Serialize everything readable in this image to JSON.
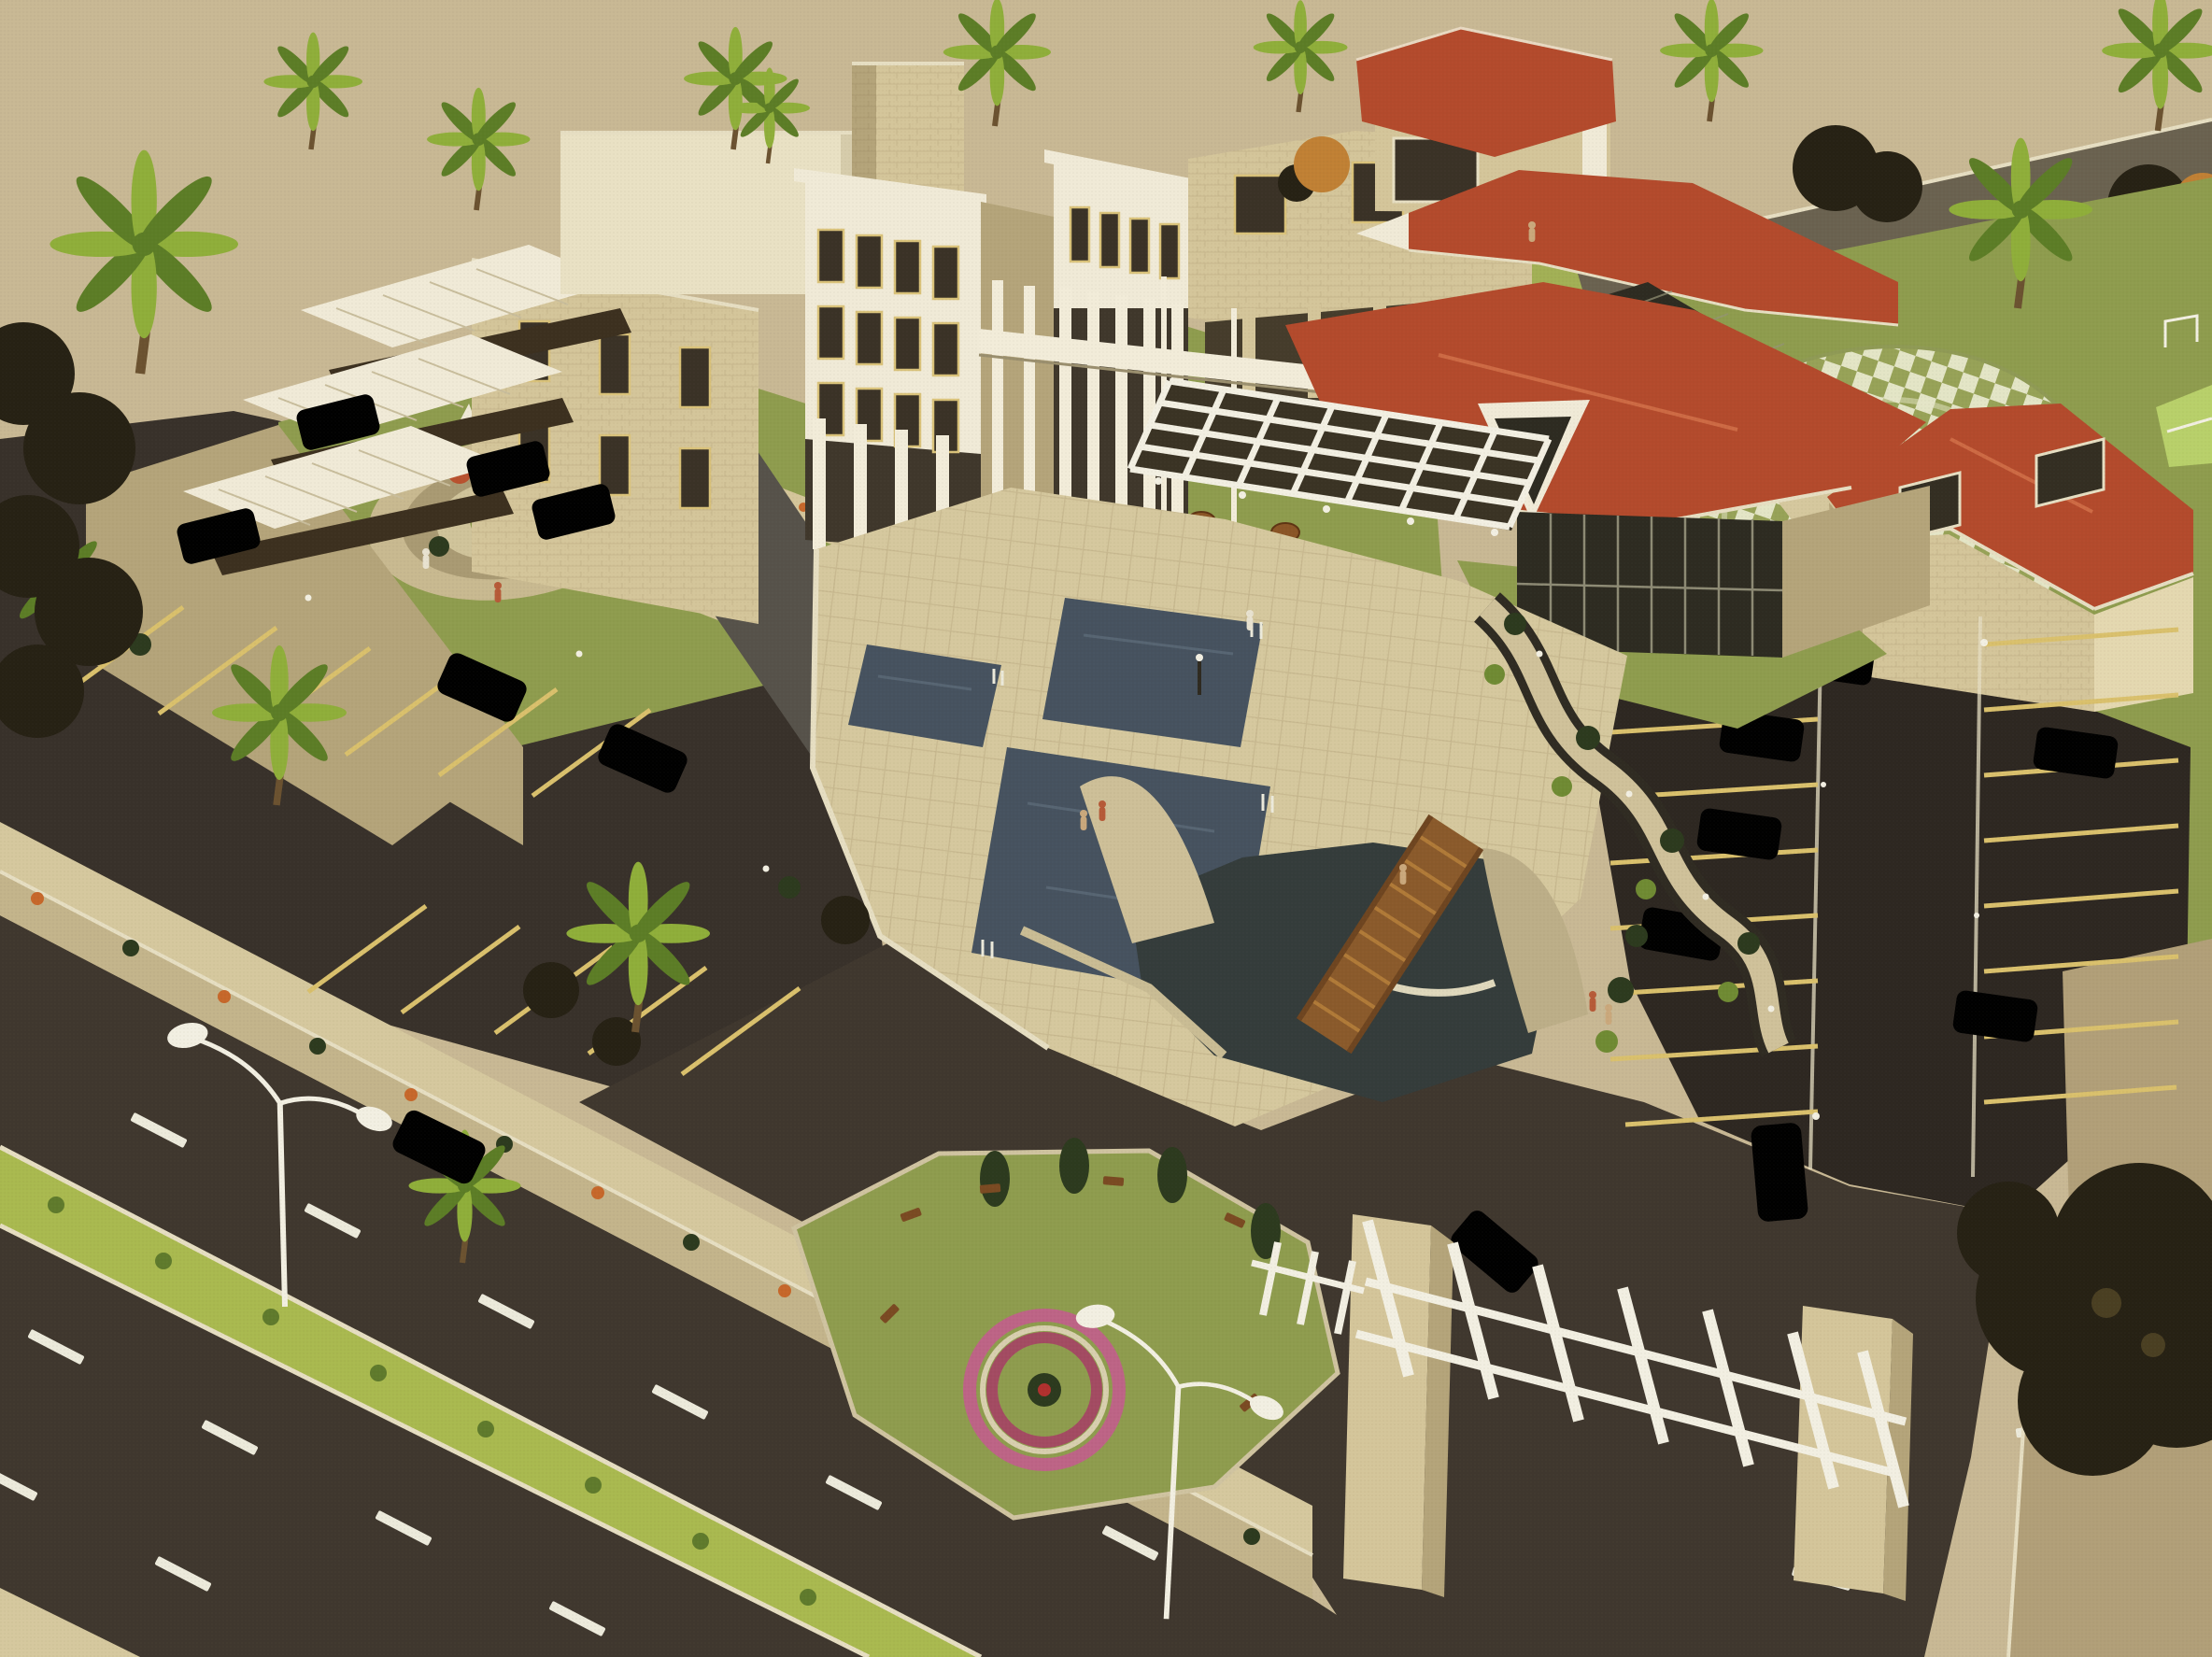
{
  "scene": {
    "type": "aerial architectural rendering",
    "description": "Bird's-eye 3D visualization of a resort hotel complex: stone hotel blocks with white colonnades and a terraced apartment wing, red hip-roof pavilions with glass atriums, three dark swimming pools on a paved deck, rooftop garden with circular mosaic, outdoor umbrella seating, circular checkered plaza, tennis court, two parking lots with yellow-lined stalls, serpentine planted walkway, water feature with arched wooden bridge, gated entrance with white pergola trellis, and a dual-carriageway road with a green median along the lower edge.",
    "areas": [
      {
        "name": "terraced-wing",
        "label": "Stepped apartment wing with white balcony canopies"
      },
      {
        "name": "main-hotel",
        "label": "Main hotel blocks with white columns and sky bridge"
      },
      {
        "name": "roof-garden",
        "label": "Roof garden terrace with circular mosaic and sculpture"
      },
      {
        "name": "red-roof-cluster",
        "label": "Red hip-roof halls with dark glass atriums"
      },
      {
        "name": "pool-pavilion",
        "label": "Red-roof pool pavilion with glass front and white pergola"
      },
      {
        "name": "pool-deck",
        "label": "Paved deck with three dark pools"
      },
      {
        "name": "umbrella-terrace",
        "label": "Outdoor seating with umbrella tables"
      },
      {
        "name": "checkered-plaza",
        "label": "Circular checkered paving plaza"
      },
      {
        "name": "right-lodge",
        "label": "Red-roof stone lodge beside plaza"
      },
      {
        "name": "left-parking",
        "label": "West parking lot with palms"
      },
      {
        "name": "right-parking",
        "label": "East parking lot with center aisle"
      },
      {
        "name": "serpentine-path",
        "label": "Winding planted walkway"
      },
      {
        "name": "water-feature",
        "label": "Pond with sail walls and arched wooden bridge"
      },
      {
        "name": "garden-island",
        "label": "Lawn island with benches and circular flower bed"
      },
      {
        "name": "entrance-gate",
        "label": "Stone pylon gate with white trellis"
      },
      {
        "name": "public-road",
        "label": "Dual carriageway with green median and street lamps"
      },
      {
        "name": "tennis-court",
        "label": "Tennis court at east lawn edge"
      }
    ],
    "counts": {
      "pools": 3,
      "umbrella_tables": 18,
      "palm_trees": 13,
      "street_lamps": 2,
      "gate_pylons": 2,
      "cars_white": 8,
      "cars_dark": 6,
      "cars_silver": 1
    }
  },
  "palette": {
    "sky": "#c8b894",
    "stone": "#d4c59a",
    "stone_dark": "#b4a47a",
    "stone_light": "#e4d8b0",
    "white_building": "#f0ead7",
    "window_dark": "#3a3226",
    "red_roof": "#b34a2c",
    "roof_ridge": "#cd6a44",
    "glass_dark": "#2d2b21",
    "grass": "#8e9c4e",
    "grass_light": "#a2b055",
    "asphalt": "#38312a",
    "asphalt_dark": "#2d2721",
    "roadway": "#3f372e",
    "median_green": "#a9b94f",
    "pavement": "#d5c89e",
    "pool_water": "#46525f",
    "feature_water": "#343c3b",
    "wood_bridge": "#8a5a2b",
    "wood_slat": "#b07a38",
    "gravel": "#b19f78",
    "stall_line": "#d9c06c",
    "lane_dash": "#eceadb",
    "curb": "#e6dec2",
    "checker_tile": "#e3e5c6",
    "checker_gap": "#97a257",
    "orange_tree": "#c08034",
    "dark_tree": "#262114",
    "conifer": "#2c3a1e",
    "palm_light": "#8fae3a",
    "palm_dark": "#5c7d26",
    "flower_orange": "#c6672a",
    "flower_pink": "#bd6486",
    "tennis_court": "#b8d06a",
    "perimeter_wall": "#6a6250",
    "sail_wall": "#cdbf98",
    "car_white": "#e9e5d6",
    "car_dark": "#201d16",
    "car_silver": "#c6c3b6",
    "lamp_white": "#f2efe2"
  }
}
